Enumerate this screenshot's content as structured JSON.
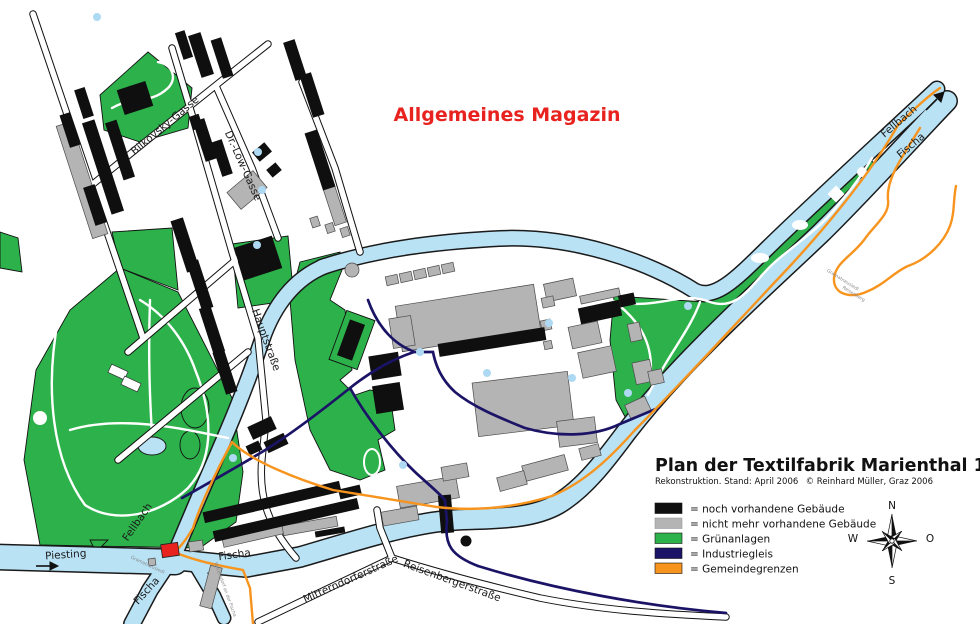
{
  "map": {
    "annotation_magazin": "Allgemeines Magazin",
    "labels": {
      "bilkovsky": "Bilkovsky-Gasse",
      "drloew": "Dr.-Löw-Gasse",
      "hauptstrasse": "Hauptstraße",
      "fellbach_ne": "Fellbach",
      "fischa_ne": "Fischa",
      "fellbach_sw": "Fellbach",
      "piesting": "Piesting",
      "fischa_s": "Fischa",
      "fischa_sw": "Fischa",
      "mitterndorferstrasse": "Mitterndorferstraße",
      "reisenbergerstrasse": "Reisenbergerstraße",
      "gramatneusiedl_s": "Gramatneusiedl",
      "mitterndorf": "Mitterndorf an der Fischa",
      "gramatneusiedl_ne": "Gramatneusiedl",
      "reisenberg_ne": "Reisenberg"
    },
    "colors": {
      "water": "#b9e2f5",
      "green": "#2db24b",
      "building_existing": "#0f0f0f",
      "building_gone": "#b4b4b4",
      "rail": "#1b1466",
      "boundary": "#f7941e",
      "highlight_red": "#e8231f"
    }
  },
  "title_block": {
    "title": "Plan der Textilfabrik Marienthal 1930",
    "status_line": "Rekonstruktion. Stand: April 2006",
    "copyright": "© Reinhard Müller, Graz 2006"
  },
  "legend": {
    "items": [
      {
        "color": "#0f0f0f",
        "label": "= noch vorhandene Gebäude"
      },
      {
        "color": "#b4b4b4",
        "label": "= nicht mehr vorhandene Gebäude"
      },
      {
        "color": "#2db24b",
        "label": "= Grünanlagen"
      },
      {
        "color": "#1b1466",
        "label": "= Industriegleis"
      },
      {
        "color": "#f7941e",
        "label": "= Gemeindegrenzen"
      }
    ]
  },
  "compass": {
    "n": "N",
    "o": "O",
    "s": "S",
    "w": "W"
  }
}
